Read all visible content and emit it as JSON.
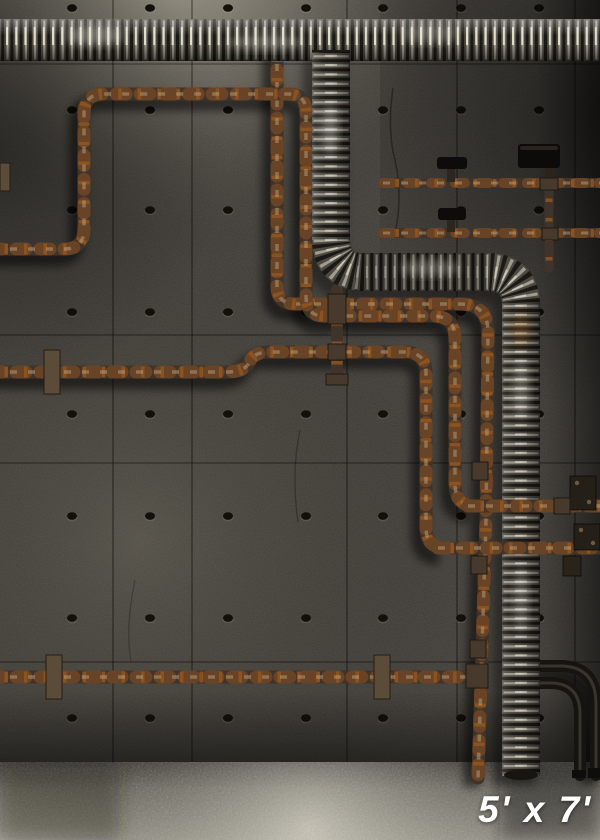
{
  "scene": {
    "type": "photographic backdrop product image",
    "description": "Industrial basement concrete wall with corrugated metal ducts, rusty meandering pipes, valve pipes and a carpet floor",
    "size_label": "5' x 7'"
  },
  "colors": {
    "wall_base": "#3f3c36",
    "wall_shadow": "#1c1b18",
    "wall_highlight": "#6a665a",
    "floor_base": "#94907f",
    "floor_highlight": "#b8b4a8",
    "duct_metal": "#4e4a43",
    "duct_specular": "#efeadb",
    "rust_pipe": "#95581f",
    "rust_pipe_dark": "#40332a",
    "dark_pipe": "#16140f",
    "label_text": "#ffffff"
  },
  "wall": {
    "hole_columns": [
      72,
      150,
      228,
      306,
      383,
      461,
      539
    ],
    "hole_rows": [
      8,
      110,
      210,
      312,
      414,
      516,
      618,
      718
    ],
    "seams_vertical": [
      113,
      192,
      347,
      457,
      575
    ],
    "seams_horizontal": [
      64,
      335,
      463,
      662
    ]
  },
  "elements": [
    "concrete-wall",
    "form-tie-holes",
    "panel-seams",
    "corrugated-duct-top",
    "corrugated-duct-branch",
    "rusty-pipe-network",
    "valve-pipes",
    "dark-elbow-pipes",
    "wall-brackets",
    "carpet-floor",
    "size-label"
  ]
}
